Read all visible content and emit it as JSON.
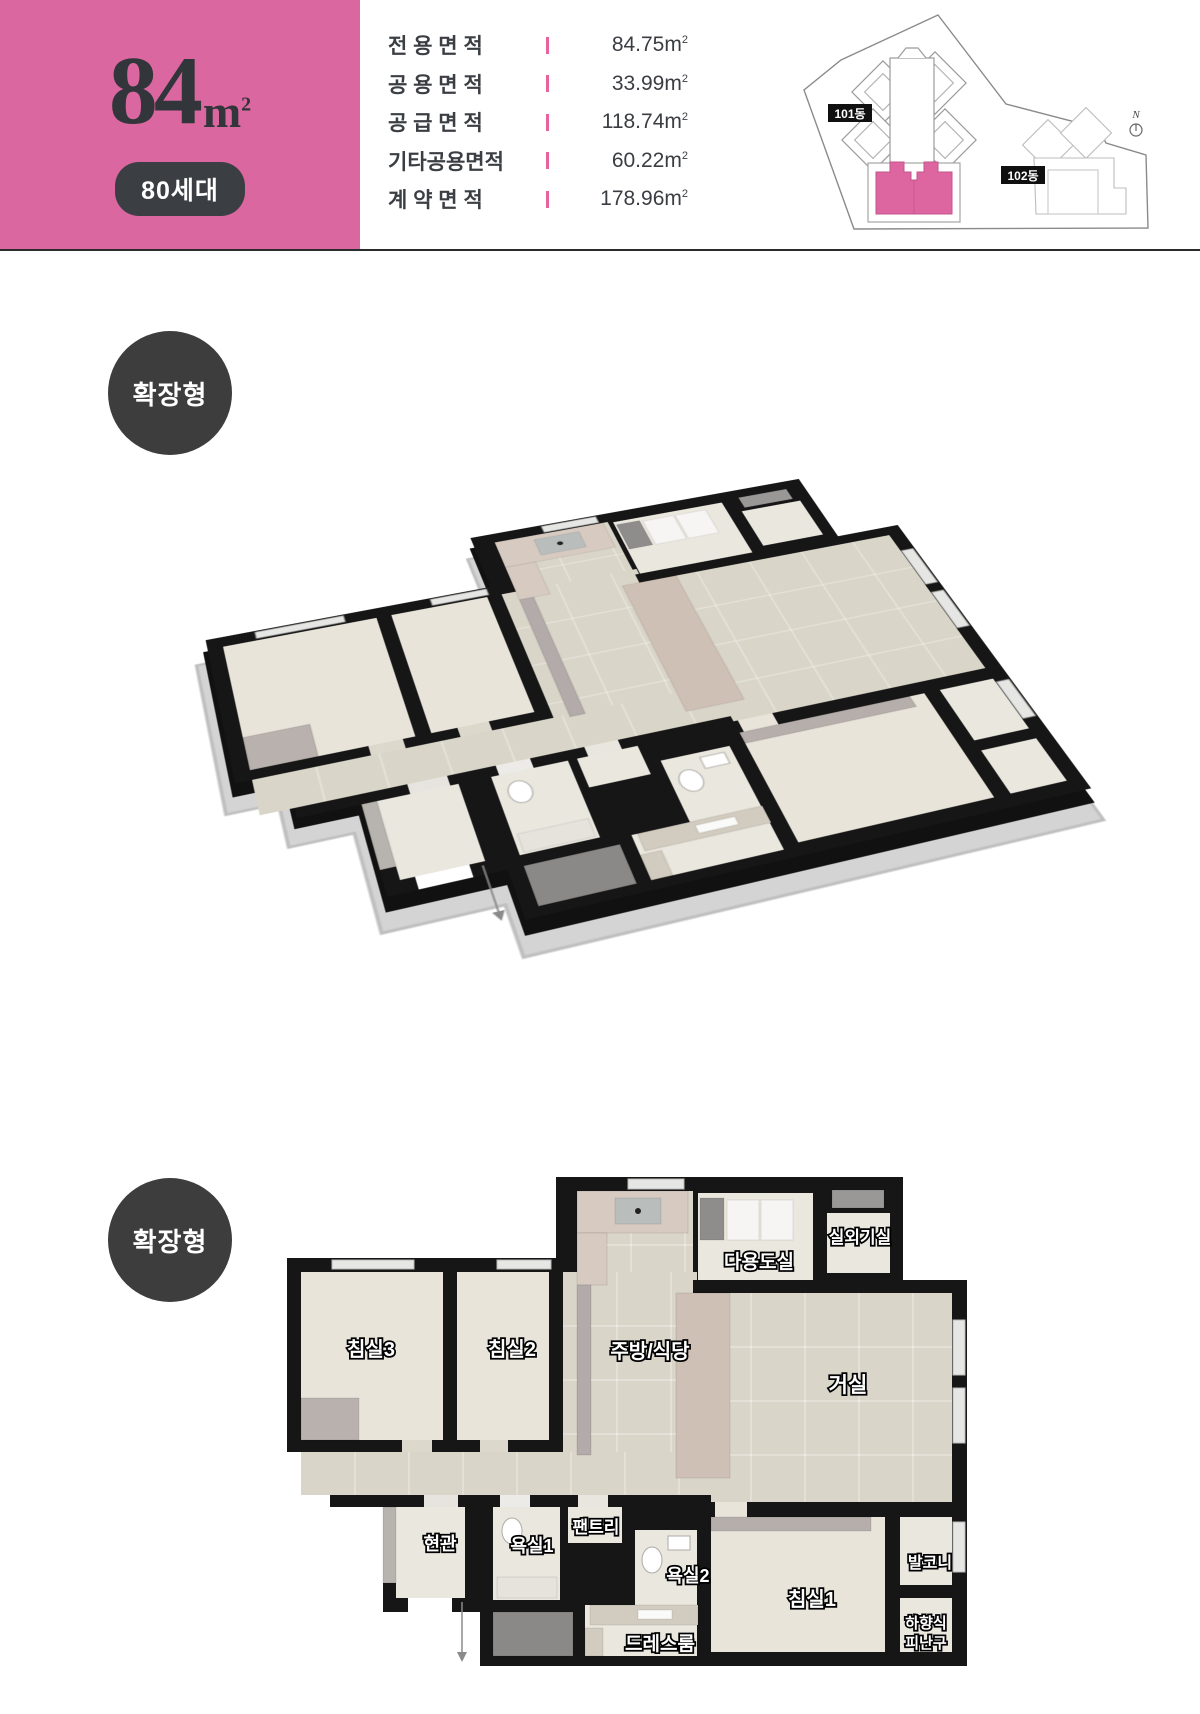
{
  "header": {
    "title_number": "84",
    "title_unit_m": "m",
    "title_unit_sup": "2",
    "badge": "80세대",
    "banner_color": "#da67a0",
    "tick_color": "#e8639e",
    "unit_m": "m",
    "unit_sup": "2",
    "area_rows": [
      {
        "label": "전 용 면 적",
        "value": "84.75"
      },
      {
        "label": "공 용 면 적",
        "value": "33.99"
      },
      {
        "label": "공 급 면 적",
        "value": "118.74"
      },
      {
        "label": "기타공용면적",
        "value": "60.22"
      },
      {
        "label": "계 약 면 적",
        "value": "178.96"
      }
    ],
    "site_plan": {
      "building_101": "101동",
      "building_102": "102동",
      "compass": "N",
      "highlight_color": "#dd66a1"
    }
  },
  "plan_3d": {
    "badge": "확장형"
  },
  "plan_2d": {
    "badge": "확장형",
    "rooms": {
      "outdoor_unit": "실외기실",
      "utility": "다용도실",
      "bedroom3": "침실3",
      "bedroom2": "침실2",
      "kitchen_dining": "주방/식당",
      "living": "거실",
      "entrance": "현관",
      "bath1": "욕실1",
      "pantry": "팬트리",
      "bath2": "욕실2",
      "bedroom1": "침실1",
      "balcony": "발코니",
      "dressroom": "드레스룸",
      "escape_hatch": "하향식 피난구"
    }
  },
  "colors": {
    "wall": "#161616",
    "wood_floor": "#e9e4da",
    "tile_floor": "#d9d5c8",
    "light_room": "#eae7df",
    "marble": "#d7cac1"
  }
}
